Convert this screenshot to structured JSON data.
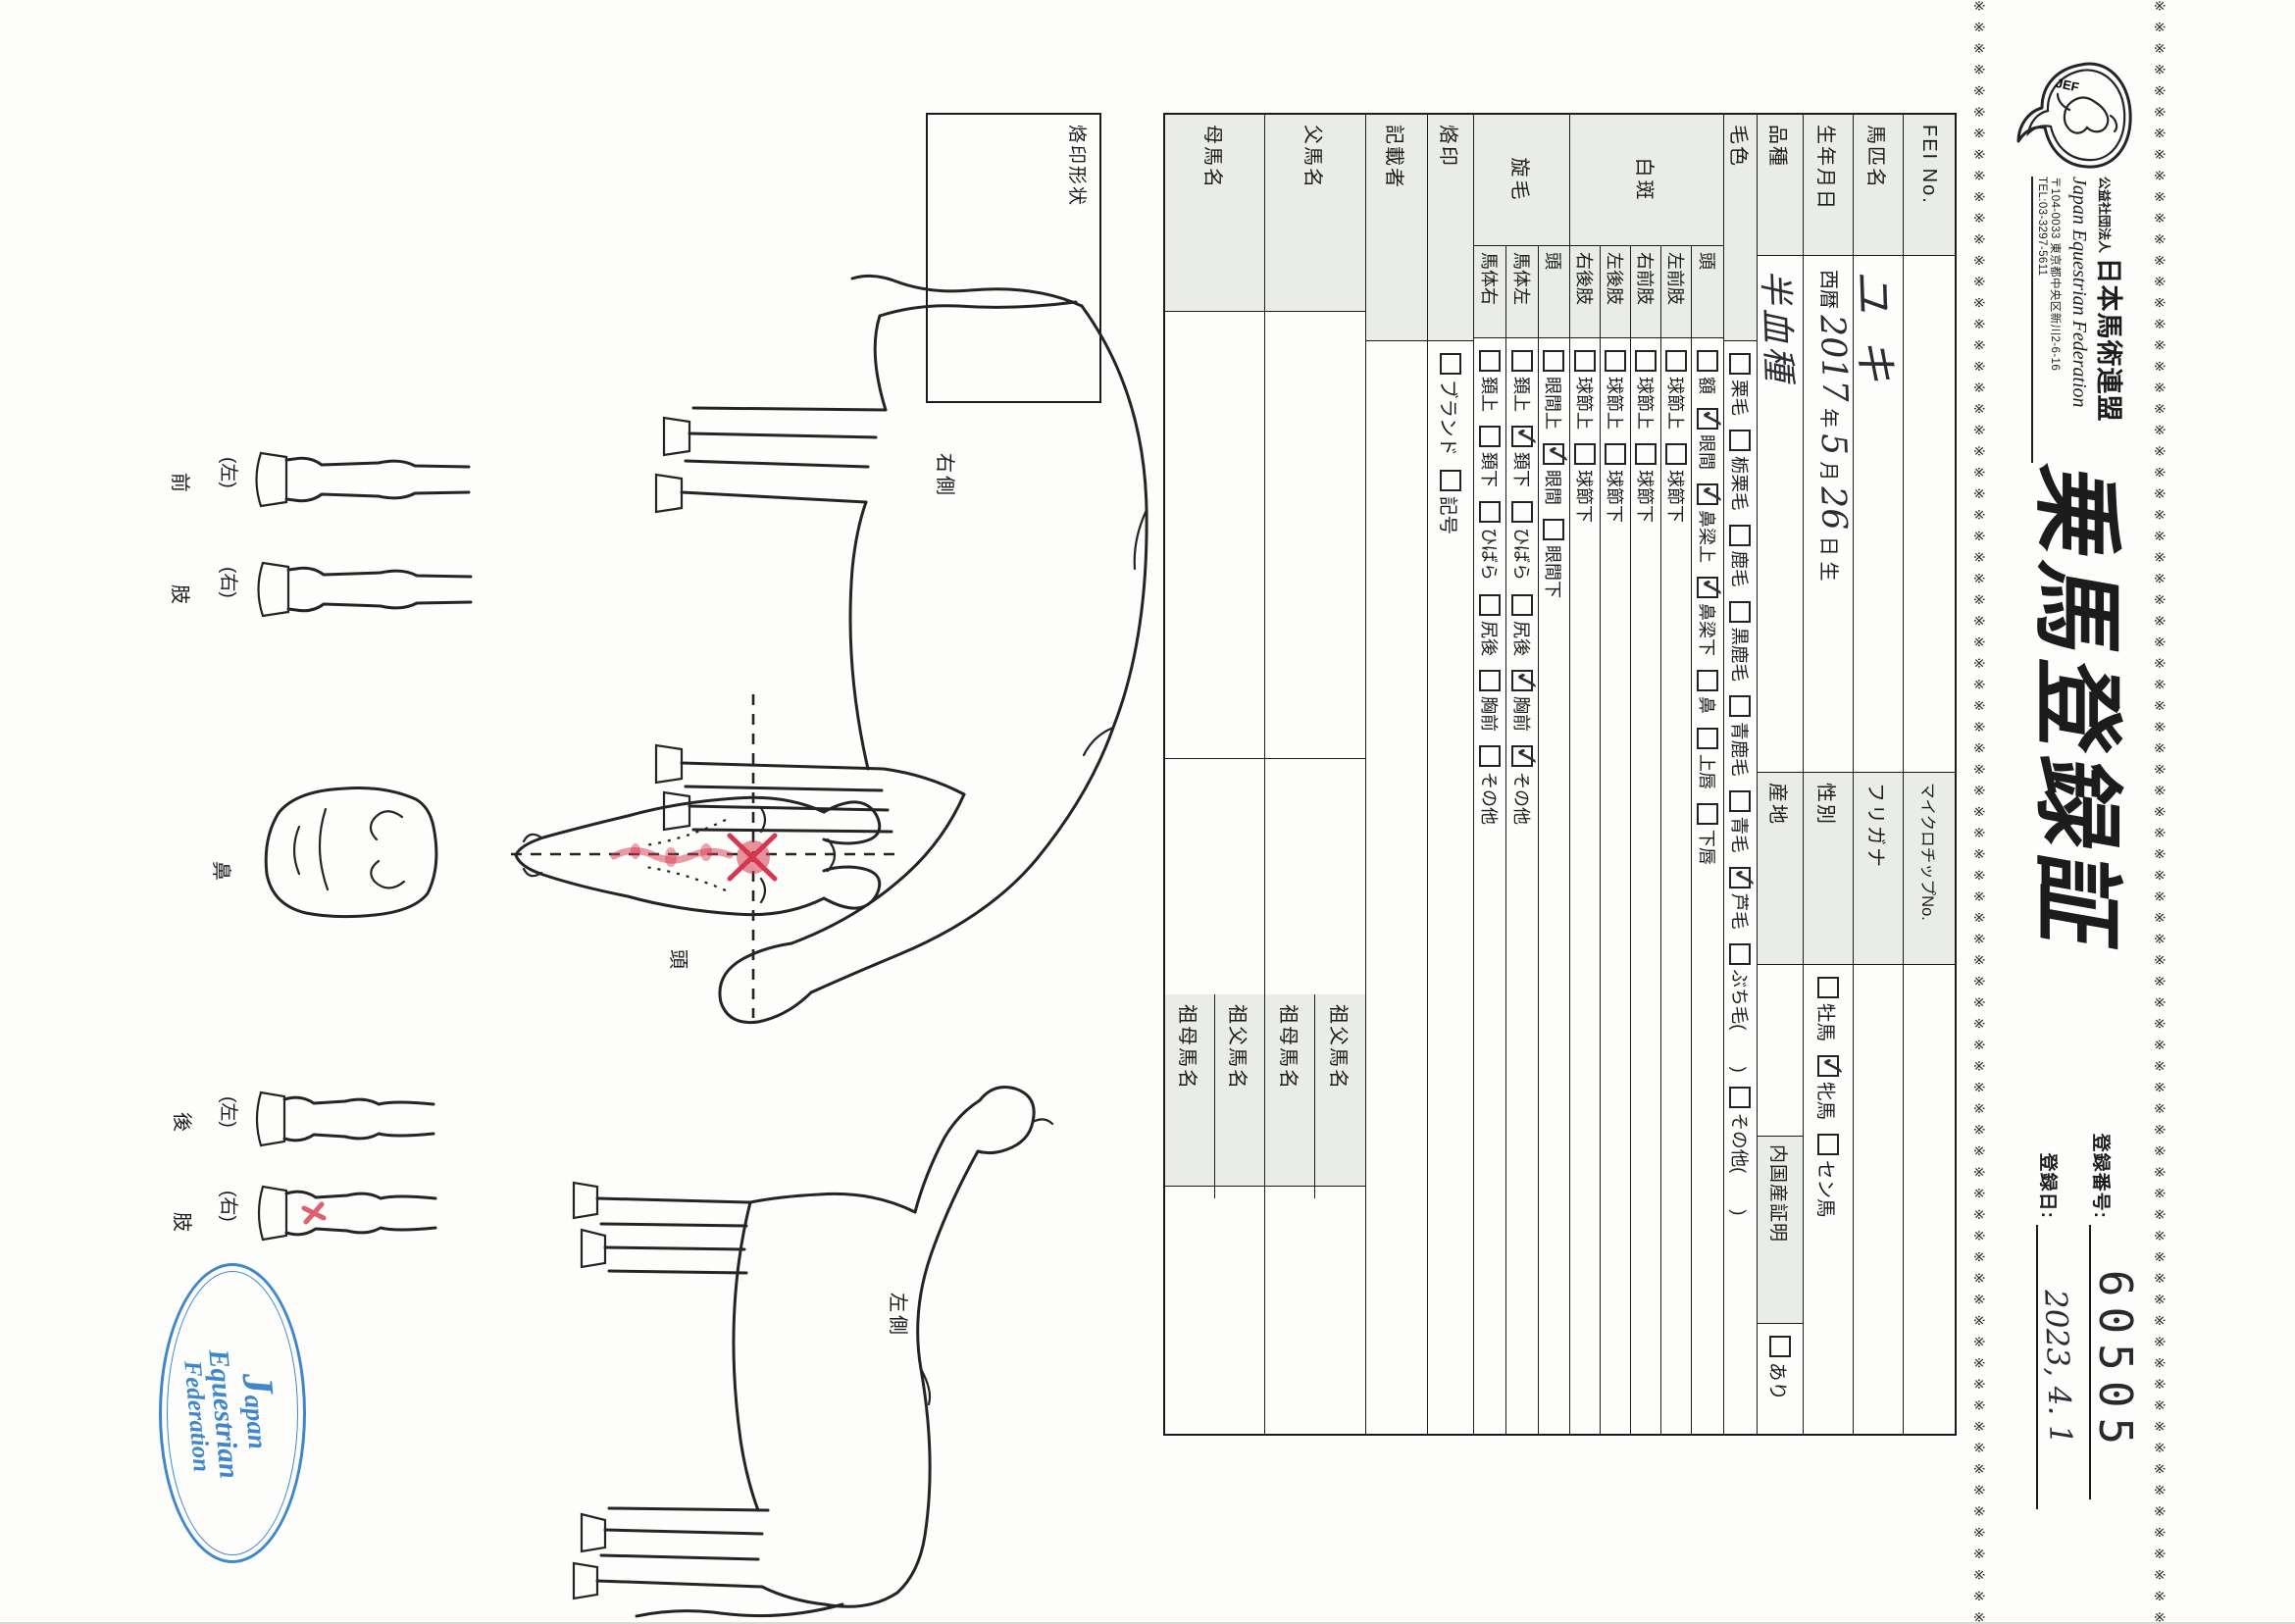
{
  "page": {
    "border_glyph": "※",
    "header": {
      "logo_text": "JEF",
      "org_prefix": "公益社団法人",
      "org_name": "日本馬術連盟",
      "org_en": "Japan Equestrian Federation",
      "postal": "〒104-0033 東京都中央区新川2-6-16",
      "tel": "TEL:03-3297-5611",
      "title": "乗馬登録証",
      "reg_no_label": "登録番号:",
      "reg_no": "60505",
      "reg_date_label": "登録日:",
      "reg_date_value": "2023, 4. 1"
    },
    "table": {
      "row1": {
        "l1": "FEI No.",
        "v1": "",
        "l2": "マイクロチップNo.",
        "v2": ""
      },
      "row2": {
        "l1": "馬匹名",
        "v1": "ユキ",
        "l2": "フリガナ",
        "v2": ""
      },
      "row3": {
        "l1": "生年月日",
        "era": "西暦",
        "year": "2017",
        "year_suffix": "年",
        "month": "5",
        "month_suffix": "月",
        "day": "26",
        "day_suffix": "日 生",
        "l2": "性別",
        "sex_options": [
          {
            "label": "牡馬",
            "checked": false
          },
          {
            "label": "牝馬",
            "checked": true
          },
          {
            "label": "セン馬",
            "checked": false
          }
        ]
      },
      "row4": {
        "l1": "品種",
        "v1": "半血種",
        "l2": "産地",
        "v2": "",
        "l3": "内国産証明",
        "domestic_options": [
          {
            "label": "あり",
            "checked": false
          }
        ]
      },
      "row5": {
        "l1": "毛色",
        "options": [
          {
            "label": "栗毛",
            "checked": false
          },
          {
            "label": "栃栗毛",
            "checked": false
          },
          {
            "label": "鹿毛",
            "checked": false
          },
          {
            "label": "黒鹿毛",
            "checked": false
          },
          {
            "label": "青鹿毛",
            "checked": false
          },
          {
            "label": "青毛",
            "checked": false
          },
          {
            "label": "芦毛",
            "checked": true
          },
          {
            "label": "ぶち毛(　　)",
            "checked": false
          },
          {
            "label": "その他(　　)",
            "checked": false
          }
        ]
      },
      "hakuhan": {
        "group": "白斑",
        "rows": [
          {
            "label": "頭",
            "options": [
              {
                "label": "額",
                "checked": false
              },
              {
                "label": "眼間",
                "checked": true
              },
              {
                "label": "鼻梁上",
                "checked": true
              },
              {
                "label": "鼻梁下",
                "checked": true
              },
              {
                "label": "鼻",
                "checked": false
              },
              {
                "label": "上唇",
                "checked": false
              },
              {
                "label": "下唇",
                "checked": false
              }
            ]
          },
          {
            "label": "左前肢",
            "options": [
              {
                "label": "球節上",
                "checked": false
              },
              {
                "label": "球節下",
                "checked": false
              }
            ]
          },
          {
            "label": "右前肢",
            "options": [
              {
                "label": "球節上",
                "checked": false
              },
              {
                "label": "球節下",
                "checked": false
              }
            ]
          },
          {
            "label": "左後肢",
            "options": [
              {
                "label": "球節上",
                "checked": false
              },
              {
                "label": "球節下",
                "checked": false
              }
            ]
          },
          {
            "label": "右後肢",
            "options": [
              {
                "label": "球節上",
                "checked": false
              },
              {
                "label": "球節下",
                "checked": false
              }
            ]
          }
        ]
      },
      "senmou": {
        "group": "旋毛",
        "rows": [
          {
            "label": "頭",
            "options": [
              {
                "label": "眼間上",
                "checked": false
              },
              {
                "label": "眼間",
                "checked": true
              },
              {
                "label": "眼間下",
                "checked": false
              }
            ]
          },
          {
            "label": "馬体左",
            "options": [
              {
                "label": "頚上",
                "checked": false
              },
              {
                "label": "頚下",
                "checked": true
              },
              {
                "label": "ひばら",
                "checked": false
              },
              {
                "label": "尻後",
                "checked": false
              },
              {
                "label": "胸前",
                "checked": true
              },
              {
                "label": "その他",
                "checked": true
              }
            ]
          },
          {
            "label": "馬体右",
            "options": [
              {
                "label": "頚上",
                "checked": false
              },
              {
                "label": "頚下",
                "checked": false
              },
              {
                "label": "ひばら",
                "checked": false
              },
              {
                "label": "尻後",
                "checked": false
              },
              {
                "label": "胸前",
                "checked": false
              },
              {
                "label": "その他",
                "checked": false
              }
            ]
          }
        ]
      },
      "rakuin": {
        "label": "烙印",
        "options": [
          {
            "label": "ブランド",
            "checked": false
          },
          {
            "label": "記号",
            "checked": false
          }
        ]
      },
      "kisaisha": {
        "label": "記載者",
        "value": ""
      },
      "pedigree": [
        {
          "label": "父馬名",
          "value": "",
          "sub": [
            {
              "label": "祖父馬名",
              "value": ""
            },
            {
              "label": "祖母馬名",
              "value": ""
            }
          ]
        },
        {
          "label": "母馬名",
          "value": "",
          "sub": [
            {
              "label": "祖父馬名",
              "value": ""
            },
            {
              "label": "祖母馬名",
              "value": ""
            }
          ]
        }
      ]
    },
    "diagram": {
      "brand_box_label": "烙印形状",
      "right_side_label": "右側",
      "left_side_label": "左側",
      "head_label": "頭",
      "nose_label": "鼻",
      "front_leg_word_1": "前",
      "front_leg_word_2": "肢",
      "hind_leg_word_1": "後",
      "hind_leg_word_2": "肢",
      "leg_left": "(左)",
      "leg_right": "(右)",
      "stamp_line1_initial": "J",
      "stamp_line1_rest": "apan",
      "stamp_line2": "Equestrian",
      "stamp_line3": "Federation"
    }
  }
}
